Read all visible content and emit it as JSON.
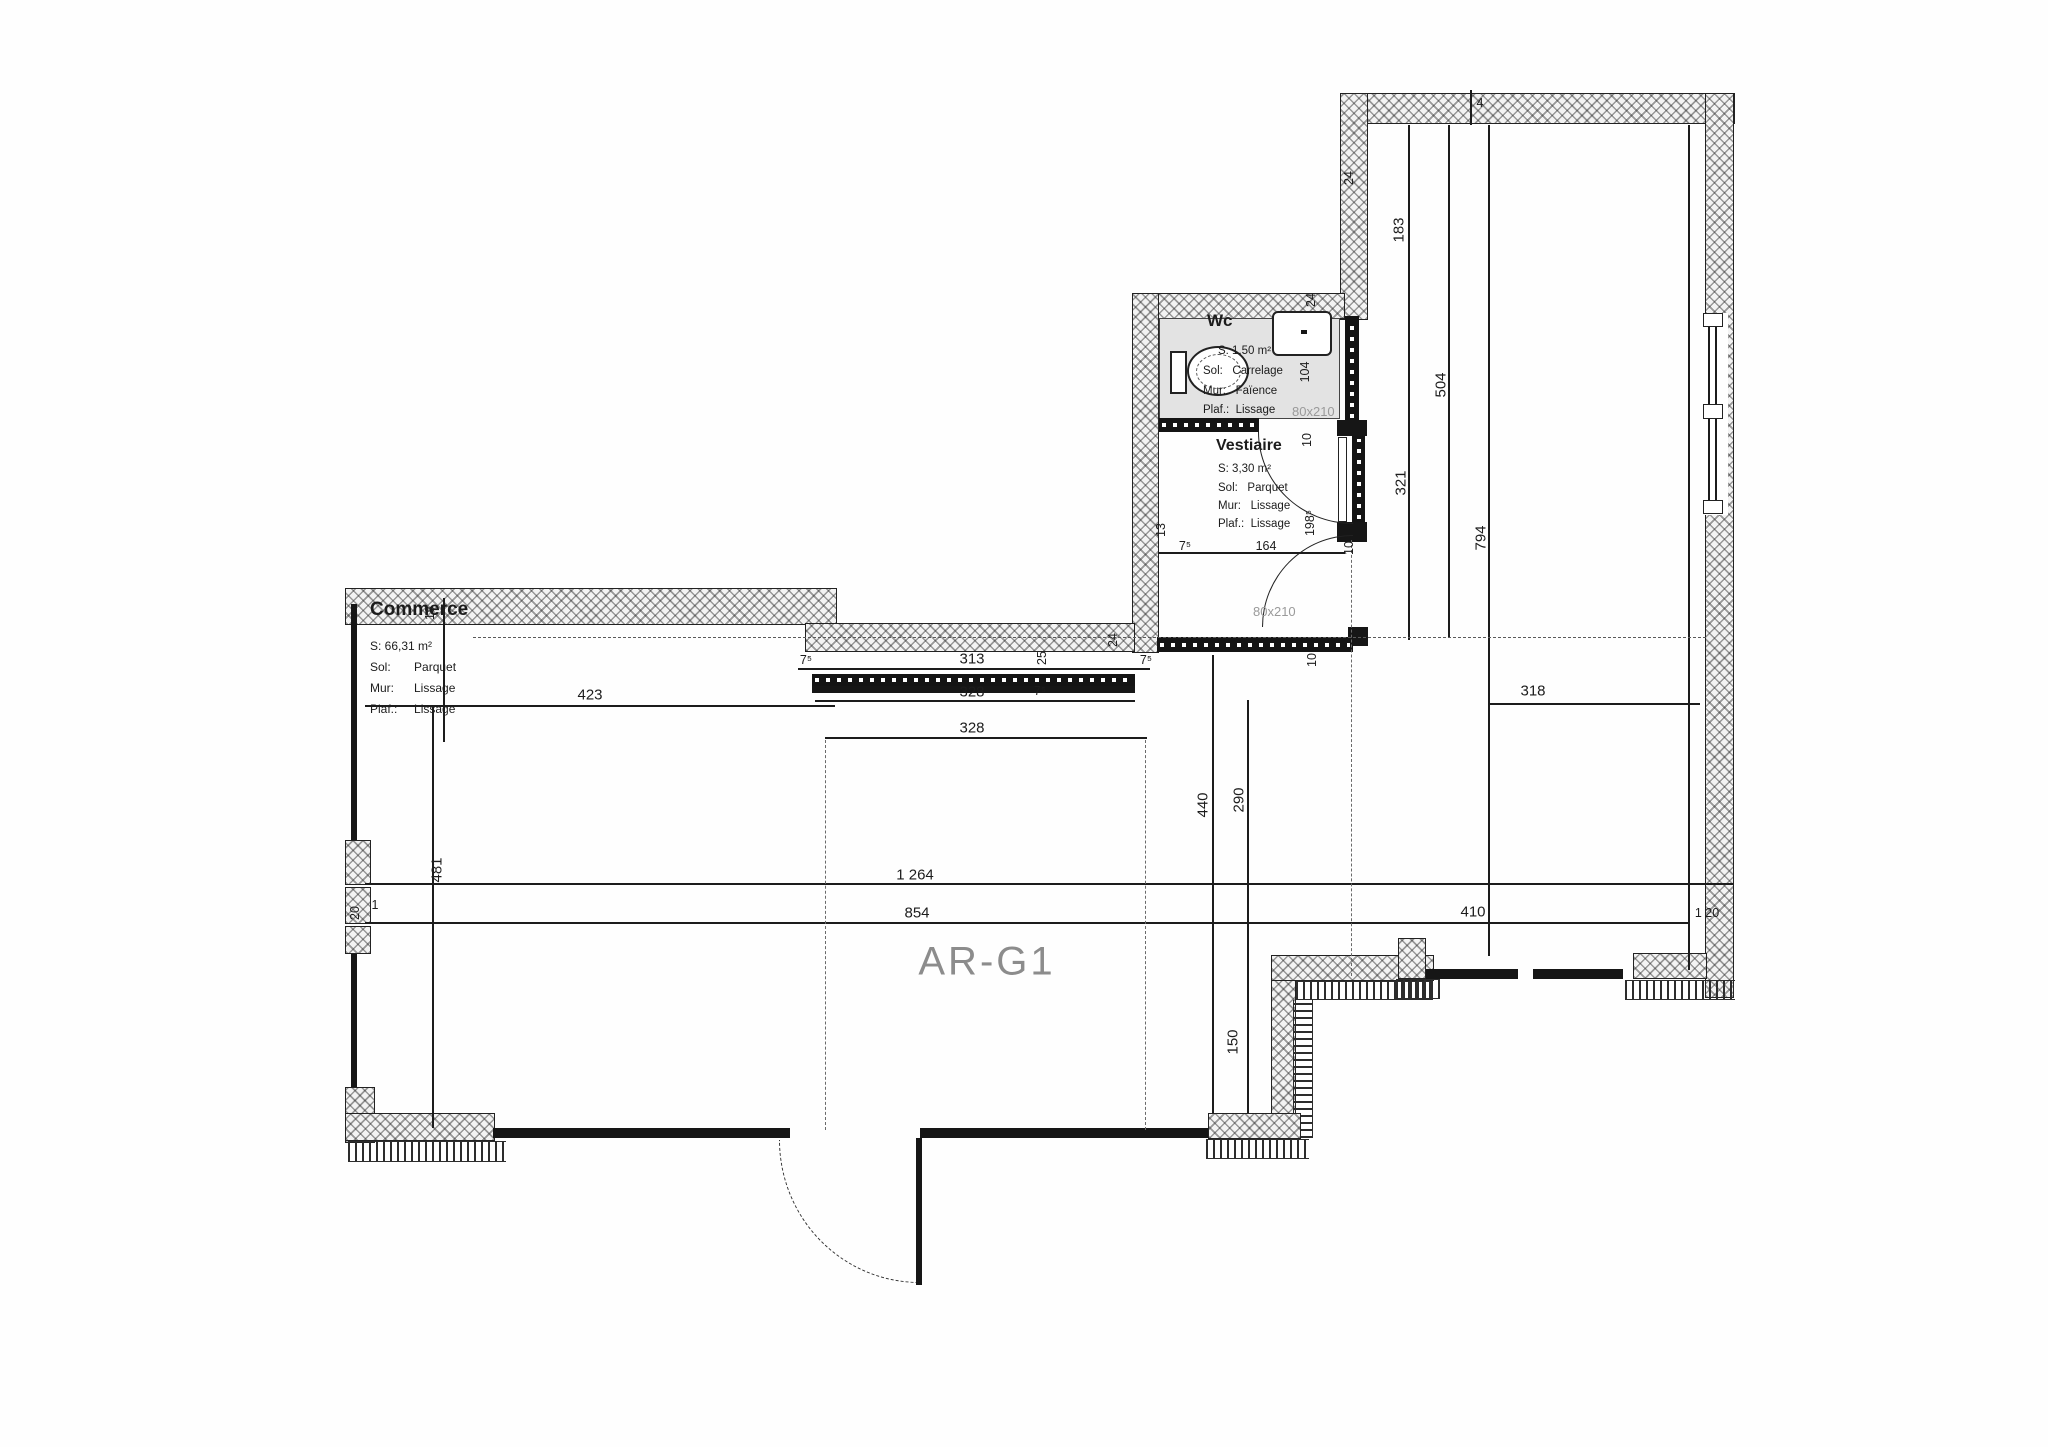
{
  "unit": {
    "label": "AR-G1"
  },
  "rooms": {
    "commerce": {
      "title": "Commerce",
      "surface": "S: 66,31 m²",
      "sol": "Sol:       Parquet",
      "mur": "Mur:      Lissage",
      "plaf": "Plaf.:     Lissage"
    },
    "wc": {
      "title": "Wc",
      "surface": "S: 1,50 m²",
      "sol": "Sol:   Carrelage",
      "mur": "Mur:   Faïence",
      "plaf": "Plaf.:  Lissage",
      "door_size": "80x210"
    },
    "vestiaire": {
      "title": "Vestiaire",
      "surface": "S: 3,30 m²",
      "sol": "Sol:   Parquet",
      "mur": "Mur:   Lissage",
      "plaf": "Plaf.:  Lissage",
      "door_size": "80x210"
    }
  },
  "dims": {
    "d423": "423",
    "d18": "18",
    "d481": "481",
    "d20": "20",
    "d1": "1",
    "d1264": "1 264",
    "d854": "854",
    "d410": "410",
    "d120": "1 20",
    "d440": "440",
    "d290": "290",
    "d150": "150",
    "d313": "313",
    "d75a": "7⁵",
    "d75b": "7⁵",
    "d75c": "7⁵",
    "d75d": "7⁵",
    "d25": "25",
    "d24a": "24",
    "d328a": "328",
    "d328b": "328",
    "d183": "183",
    "d24b": "24",
    "d4": "4",
    "d504": "504",
    "d321": "321",
    "d794": "794",
    "d318": "318",
    "d24c": "24",
    "d104": "104",
    "d10a": "10",
    "d10b": "10",
    "d10c": "10",
    "d13": "13",
    "d164": "164",
    "d198": "198⁵"
  },
  "colors": {
    "line": "#1c1c1c",
    "door_label": "#9a9a9a",
    "unit_label": "#8c8c8c",
    "wc_fill": "#e3e3e3"
  }
}
